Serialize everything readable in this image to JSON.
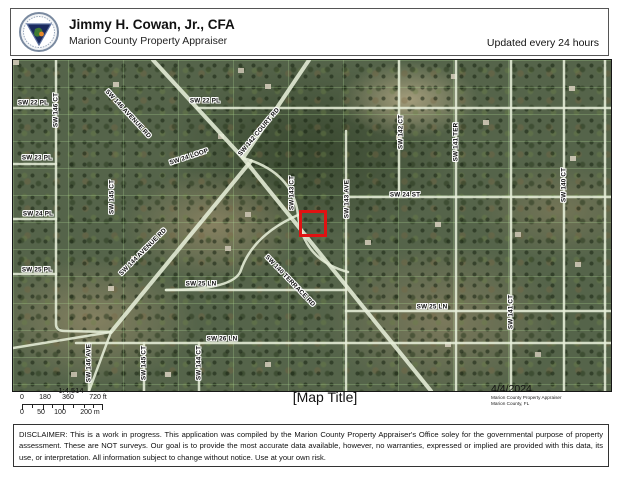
{
  "header": {
    "title": "Jimmy H. Cowan, Jr., CFA",
    "subtitle": "Marion County Property Appraiser",
    "updated": "Updated every 24 hours"
  },
  "map": {
    "parcel": {
      "highlight_color": "#e01212"
    },
    "street_labels": [
      {
        "text": "SW 22 PL",
        "x": 20,
        "y": 43,
        "rot": 0
      },
      {
        "text": "SW 146 CT",
        "x": 43,
        "y": 50,
        "rot": -90
      },
      {
        "text": "SW 146 AVENUE RD",
        "x": 115,
        "y": 54,
        "rot": 47
      },
      {
        "text": "SW 22 PL",
        "x": 192,
        "y": 41,
        "rot": 0
      },
      {
        "text": "SW 142 COURT RD",
        "x": 246,
        "y": 72,
        "rot": -50
      },
      {
        "text": "SW 23 PL",
        "x": 24,
        "y": 98,
        "rot": 0
      },
      {
        "text": "SW 145 CT",
        "x": 99,
        "y": 137,
        "rot": -90
      },
      {
        "text": "SW 24 LOOP",
        "x": 176,
        "y": 97,
        "rot": -18
      },
      {
        "text": "SW 24 PL",
        "x": 25,
        "y": 154,
        "rot": 0
      },
      {
        "text": "SW 143 CT",
        "x": 279,
        "y": 133,
        "rot": -90
      },
      {
        "text": "SW 143 AVE",
        "x": 334,
        "y": 139,
        "rot": -90
      },
      {
        "text": "SW 142 CT",
        "x": 388,
        "y": 72,
        "rot": -90
      },
      {
        "text": "SW 141 TER",
        "x": 443,
        "y": 82,
        "rot": -90
      },
      {
        "text": "SW 24 ST",
        "x": 392,
        "y": 135,
        "rot": 0
      },
      {
        "text": "SW 140 CT",
        "x": 551,
        "y": 125,
        "rot": -90
      },
      {
        "text": "SW 25 PL",
        "x": 24,
        "y": 210,
        "rot": 0
      },
      {
        "text": "SW 144 AVENUE RD",
        "x": 130,
        "y": 192,
        "rot": -45
      },
      {
        "text": "SW 25 LN",
        "x": 188,
        "y": 224,
        "rot": 0
      },
      {
        "text": "SW 140 TERRACE RD",
        "x": 277,
        "y": 221,
        "rot": 46
      },
      {
        "text": "SW 26 LN",
        "x": 209,
        "y": 279,
        "rot": 0
      },
      {
        "text": "SW 146 AVE",
        "x": 76,
        "y": 303,
        "rot": -90
      },
      {
        "text": "SW 145 CT",
        "x": 131,
        "y": 303,
        "rot": -90
      },
      {
        "text": "SW 144 CT",
        "x": 186,
        "y": 303,
        "rot": -90
      },
      {
        "text": "SW 25 LN",
        "x": 419,
        "y": 247,
        "rot": 0
      },
      {
        "text": "SW 141 CT",
        "x": 498,
        "y": 252,
        "rot": -90
      }
    ]
  },
  "footer": {
    "scale_ratio": "1:4,514",
    "scale_ft_labels": [
      "0",
      "180",
      "360",
      "720 ft"
    ],
    "scale_m_labels": [
      "0",
      "50",
      "100",
      "200 m"
    ],
    "map_title": "[Map Title]",
    "date": "4/4/2024",
    "attribution1": "Marion County Property Appraiser",
    "attribution2": "Marion County, FL"
  },
  "disclaimer": {
    "text": "DISCLAIMER: This is a work in progress. This application was compiled by the Marion County Property Appraiser's Office soley for the governmental purpose of property assessment. These are NOT surveys. Our goal is to provide the most accurate data available, however, no warranties, expressed or implied are provided with this data, its use, or interpretation. All information subject to change without notice. Use at your own risk."
  }
}
